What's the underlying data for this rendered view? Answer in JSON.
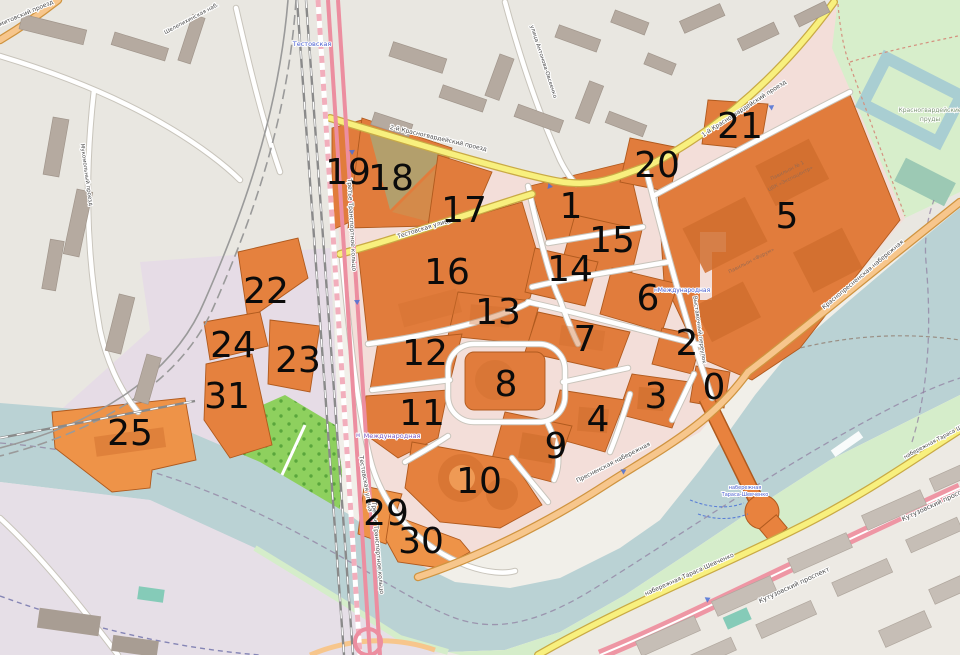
{
  "plots": {
    "0": "0",
    "1": "1",
    "2": "2",
    "3": "3",
    "4": "4",
    "5": "5",
    "6": "6",
    "7": "7",
    "8": "8",
    "9": "9",
    "10": "10",
    "11": "11",
    "12": "12",
    "13": "13",
    "14": "14",
    "15": "15",
    "16": "16",
    "17": "17",
    "18": "18",
    "19": "19",
    "20": "20",
    "21": "21",
    "22": "22",
    "23": "23",
    "24": "24",
    "25": "25",
    "29": "29",
    "30": "30",
    "31": "31"
  },
  "streets": {
    "testovskaya_1": "Тестовская улица",
    "testovskaya_2": "Тестовская улица",
    "presnenskaya_nab": "Пресненская набережная",
    "krasnopresnenskaya_nab": "Краснопресненская набережная",
    "krasnogvardeysky_1": "1-й Красногвардейский проезд",
    "krasnogvardeysky_2": "2-й Красногвардейский проезд",
    "vystavochny_per": "Выставочный переулок",
    "ttk_1": "Третье Транспортное кольцо",
    "ttk_2": "Третье Транспортное кольцо",
    "kutuzovsky_1": "Кутузовский проспект",
    "kutuzovsky_2": "Кутузовский проспект",
    "taras_shevchenko_1": "набережная Тараса Шевченко",
    "taras_shevchenko_2": "набережная Тараса Шевченко",
    "antonova_ovseenko": "улица Антонова-Овсеенко",
    "mukomolny": "Мукомольный проезд",
    "shmitovsky": "Шмитовский проезд",
    "shelepikhinskaya": "Шелепихинская наб."
  },
  "transit": {
    "testovskaya_station": "Тестовская",
    "mezhdunarodnaya_1": "Международная",
    "mezhdunarodnaya_2": "Международная",
    "metro_m_1": "М",
    "metro_m_2": "М"
  },
  "places": {
    "park_line1": "Красногвардейские",
    "park_line2": "пруды",
    "pavilion_1a": "Павильон № 1",
    "pavilion_1b": "ЦВК «Экспоцентр»",
    "pavilion_forum": "Павильон «Форум»",
    "pier_line1": "набережная",
    "pier_line2": "Тараса-Шевченко"
  },
  "colors": {
    "plot_orange": "#e17c3c",
    "water": "#bad2d4",
    "park_bright": "#8ed05e",
    "park_pale": "#d7eecb",
    "road_yellow": "#f8f07e",
    "road_orange": "#f7c68c",
    "road_pink": "#ec8ea0",
    "industrial_building": "#b5aaa0"
  }
}
